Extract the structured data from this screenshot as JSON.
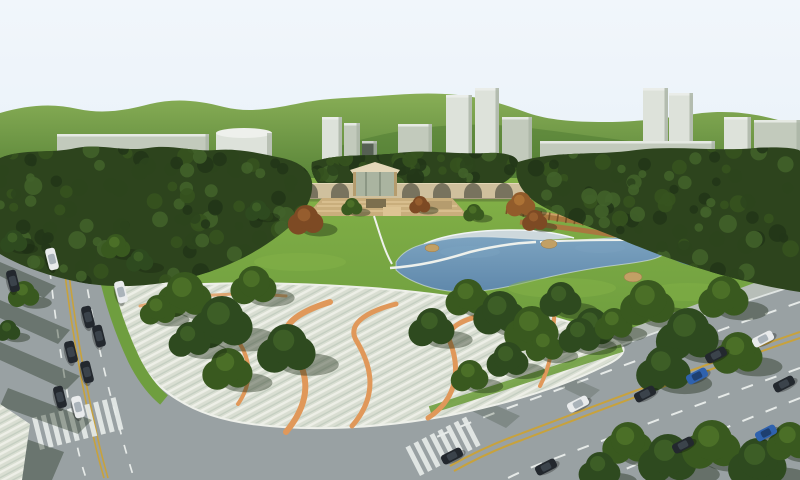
{
  "scene": {
    "description": "Aerial 3D architectural rendering of an urban park master plan: central lake with beach and rocks, large striped pedestrian plazas with winding orange ribbon paths, dense tree clusters, an arched arcade bridge structure with pavilion and terraces, a long wooden screen wall, perimeter arterial roads with traffic, schematic massing buildings and green hills on the skyline",
    "style": "computer-generated visualization, daytime, no visible text"
  },
  "palette": {
    "sky_top": "#f1f6fb",
    "sky_bottom": "#ddeaf4",
    "hill_light": "#88ae56",
    "hill_dark": "#4e7a31",
    "building_light": "#dde2da",
    "building_mid": "#c2cabc",
    "building_side": "#a9b3a4",
    "building_top": "#eef0ec",
    "building_dark_tower": "#566053",
    "forest": "#2d441d",
    "lawn_light": "#83b147",
    "lawn": "#6f9e3f",
    "lawn_dark": "#5a8a33",
    "water": "#5f88ab",
    "water_light": "#7ca3c0",
    "beach": "#cdd8dc",
    "beach_edge": "#f0f4f4",
    "rock": "#c2a065",
    "plaza_base": "#d9ded2",
    "plaza_stripe": "#edefe7",
    "plaza_stripe_dark": "#c4cec1",
    "ribbon": "#e0985a",
    "road": "#99a1a3",
    "sidewalk": "#b7beb8",
    "line_white": "#e6eae8",
    "line_yellow": "#c8a23c",
    "arch_wall": "#cfc09d",
    "arch_opening": "#6e6a58",
    "arch_coping": "#e4d8b9",
    "terrace": "#c9ae7c",
    "terrace_step": "#ddc494",
    "terrace_dark": "#7c6f4e",
    "pavilion_glass": "#aab4a0",
    "pavilion_post": "#b59c6e",
    "wood_wall": "#a9783f",
    "wood_dark": "#6b4a22",
    "wood_light": "#caa065",
    "shadow": "rgba(25,40,18,0.40)",
    "path_white": "#eef1ec",
    "car_white": "#e9ebec",
    "car_black": "#23282e",
    "car_blue": "#2f62ae"
  },
  "skyline": {
    "buildings": [
      {
        "x": 57,
        "y": 134,
        "w": 152,
        "h": 44,
        "tone": "building_mid",
        "shape": "box"
      },
      {
        "x": 216,
        "y": 128,
        "w": 56,
        "h": 32,
        "tone": "building_light",
        "shape": "cylinder"
      },
      {
        "x": 322,
        "y": 117,
        "w": 20,
        "h": 58,
        "tone": "building_light",
        "shape": "box"
      },
      {
        "x": 344,
        "y": 123,
        "w": 16,
        "h": 52,
        "tone": "building_mid",
        "shape": "box"
      },
      {
        "x": 362,
        "y": 141,
        "w": 15,
        "h": 46,
        "tone": "building_dark_tower",
        "shape": "box"
      },
      {
        "x": 398,
        "y": 124,
        "w": 34,
        "h": 44,
        "tone": "building_mid",
        "shape": "box"
      },
      {
        "x": 446,
        "y": 95,
        "w": 26,
        "h": 66,
        "tone": "building_light",
        "shape": "box"
      },
      {
        "x": 475,
        "y": 88,
        "w": 24,
        "h": 73,
        "tone": "building_light",
        "shape": "box"
      },
      {
        "x": 502,
        "y": 117,
        "w": 30,
        "h": 48,
        "tone": "building_mid",
        "shape": "box"
      },
      {
        "x": 540,
        "y": 141,
        "w": 86,
        "h": 32,
        "tone": "building_mid",
        "shape": "box"
      },
      {
        "x": 643,
        "y": 88,
        "w": 25,
        "h": 78,
        "tone": "building_light",
        "shape": "box"
      },
      {
        "x": 669,
        "y": 93,
        "w": 24,
        "h": 73,
        "tone": "building_light",
        "shape": "box"
      },
      {
        "x": 620,
        "y": 141,
        "w": 95,
        "h": 33,
        "tone": "building_mid",
        "shape": "box"
      },
      {
        "x": 724,
        "y": 117,
        "w": 27,
        "h": 58,
        "tone": "building_light",
        "shape": "box"
      },
      {
        "x": 754,
        "y": 120,
        "w": 46,
        "h": 62,
        "tone": "building_mid",
        "shape": "box"
      }
    ]
  },
  "arch_bridge": {
    "arches_x": [
      247,
      278,
      309,
      340,
      411,
      442,
      473,
      504
    ],
    "arch_y": 198,
    "arch_rx": 9,
    "arch_ry": 11
  },
  "vegetation": {
    "trees": [
      {
        "x": 185,
        "y": 298,
        "r": 26,
        "t": "mid"
      },
      {
        "x": 222,
        "y": 326,
        "r": 30,
        "t": "dark"
      },
      {
        "x": 254,
        "y": 288,
        "r": 22,
        "t": "mid"
      },
      {
        "x": 287,
        "y": 352,
        "r": 28,
        "t": "dark"
      },
      {
        "x": 228,
        "y": 372,
        "r": 24,
        "t": "mid"
      },
      {
        "x": 190,
        "y": 342,
        "r": 20,
        "t": "dark"
      },
      {
        "x": 158,
        "y": 312,
        "r": 17,
        "t": "mid"
      },
      {
        "x": 432,
        "y": 330,
        "r": 22,
        "t": "dark"
      },
      {
        "x": 468,
        "y": 300,
        "r": 21,
        "t": "mid"
      },
      {
        "x": 500,
        "y": 316,
        "r": 25,
        "t": "dark"
      },
      {
        "x": 532,
        "y": 332,
        "r": 26,
        "t": "mid"
      },
      {
        "x": 561,
        "y": 302,
        "r": 20,
        "t": "dark"
      },
      {
        "x": 592,
        "y": 330,
        "r": 22,
        "t": "dark"
      },
      {
        "x": 470,
        "y": 378,
        "r": 18,
        "t": "mid"
      },
      {
        "x": 508,
        "y": 362,
        "r": 20,
        "t": "dark"
      },
      {
        "x": 545,
        "y": 348,
        "r": 18,
        "t": "mid"
      },
      {
        "x": 580,
        "y": 338,
        "r": 20,
        "t": "dark"
      },
      {
        "x": 614,
        "y": 326,
        "r": 18,
        "t": "mid"
      },
      {
        "x": 648,
        "y": 306,
        "r": 26,
        "t": "mid"
      },
      {
        "x": 688,
        "y": 338,
        "r": 30,
        "t": "dark"
      },
      {
        "x": 724,
        "y": 300,
        "r": 24,
        "t": "mid"
      },
      {
        "x": 664,
        "y": 372,
        "r": 26,
        "t": "dark"
      },
      {
        "x": 738,
        "y": 356,
        "r": 24,
        "t": "mid"
      },
      {
        "x": 628,
        "y": 446,
        "r": 24,
        "t": "mid"
      },
      {
        "x": 668,
        "y": 462,
        "r": 28,
        "t": "dark"
      },
      {
        "x": 712,
        "y": 448,
        "r": 28,
        "t": "mid"
      },
      {
        "x": 758,
        "y": 466,
        "r": 28,
        "t": "dark"
      },
      {
        "x": 790,
        "y": 444,
        "r": 22,
        "t": "mid"
      },
      {
        "x": 600,
        "y": 472,
        "r": 20,
        "t": "dark"
      },
      {
        "x": 306,
        "y": 222,
        "r": 17,
        "t": "autumn"
      },
      {
        "x": 521,
        "y": 206,
        "r": 14,
        "t": "autumn2"
      },
      {
        "x": 535,
        "y": 222,
        "r": 12,
        "t": "autumn"
      },
      {
        "x": 420,
        "y": 206,
        "r": 10,
        "t": "autumn"
      },
      {
        "x": 258,
        "y": 212,
        "r": 12,
        "t": "dark"
      },
      {
        "x": 352,
        "y": 208,
        "r": 10,
        "t": "mid"
      },
      {
        "x": 474,
        "y": 214,
        "r": 10,
        "t": "mid"
      },
      {
        "x": 14,
        "y": 243,
        "r": 13,
        "t": "dark"
      },
      {
        "x": 24,
        "y": 296,
        "r": 15,
        "t": "mid"
      },
      {
        "x": 8,
        "y": 332,
        "r": 12,
        "t": "dark"
      },
      {
        "x": 116,
        "y": 248,
        "r": 14,
        "t": "mid"
      },
      {
        "x": 140,
        "y": 262,
        "r": 13,
        "t": "dark"
      }
    ]
  },
  "pond": {
    "rocks": [
      {
        "x": 432,
        "y": 248,
        "r": 7
      },
      {
        "x": 549,
        "y": 244,
        "r": 8
      },
      {
        "x": 633,
        "y": 277,
        "r": 9
      },
      {
        "x": 668,
        "y": 241,
        "r": 5
      },
      {
        "x": 760,
        "y": 252,
        "r": 6
      }
    ]
  },
  "traffic": {
    "cars": [
      {
        "x": 52,
        "y": 259,
        "rot": 76,
        "c": "car_white"
      },
      {
        "x": 13,
        "y": 281,
        "rot": 76,
        "c": "car_black"
      },
      {
        "x": 121,
        "y": 292,
        "rot": 76,
        "c": "car_white"
      },
      {
        "x": 88,
        "y": 317,
        "rot": 76,
        "c": "car_black"
      },
      {
        "x": 99,
        "y": 336,
        "rot": 76,
        "c": "car_black"
      },
      {
        "x": 71,
        "y": 352,
        "rot": 76,
        "c": "car_black"
      },
      {
        "x": 87,
        "y": 372,
        "rot": 76,
        "c": "car_black"
      },
      {
        "x": 60,
        "y": 397,
        "rot": 76,
        "c": "car_black"
      },
      {
        "x": 78,
        "y": 407,
        "rot": 76,
        "c": "car_white"
      },
      {
        "x": 578,
        "y": 404,
        "rot": -27,
        "c": "car_white"
      },
      {
        "x": 645,
        "y": 394,
        "rot": -27,
        "c": "car_black"
      },
      {
        "x": 697,
        "y": 376,
        "rot": -27,
        "c": "car_blue"
      },
      {
        "x": 716,
        "y": 355,
        "rot": -27,
        "c": "car_black"
      },
      {
        "x": 763,
        "y": 339,
        "rot": -27,
        "c": "car_white"
      },
      {
        "x": 784,
        "y": 384,
        "rot": -27,
        "c": "car_black"
      },
      {
        "x": 683,
        "y": 445,
        "rot": -27,
        "c": "car_black"
      },
      {
        "x": 766,
        "y": 433,
        "rot": -27,
        "c": "car_blue"
      },
      {
        "x": 546,
        "y": 467,
        "rot": -27,
        "c": "car_black"
      },
      {
        "x": 452,
        "y": 456,
        "rot": -27,
        "c": "car_black"
      }
    ]
  },
  "roads": {
    "crosswalks": [
      {
        "x": 420,
        "y": 476,
        "rot": -27,
        "bars": 8,
        "step": 9,
        "w": 5,
        "h": 32
      },
      {
        "x": 40,
        "y": 450,
        "rot": -14,
        "bars": 10,
        "step": 9,
        "w": 5,
        "h": 33
      },
      {
        "x": 2,
        "y": 252,
        "rot": -22,
        "bars": 6,
        "step": 8,
        "w": 4.5,
        "h": 26
      }
    ]
  }
}
